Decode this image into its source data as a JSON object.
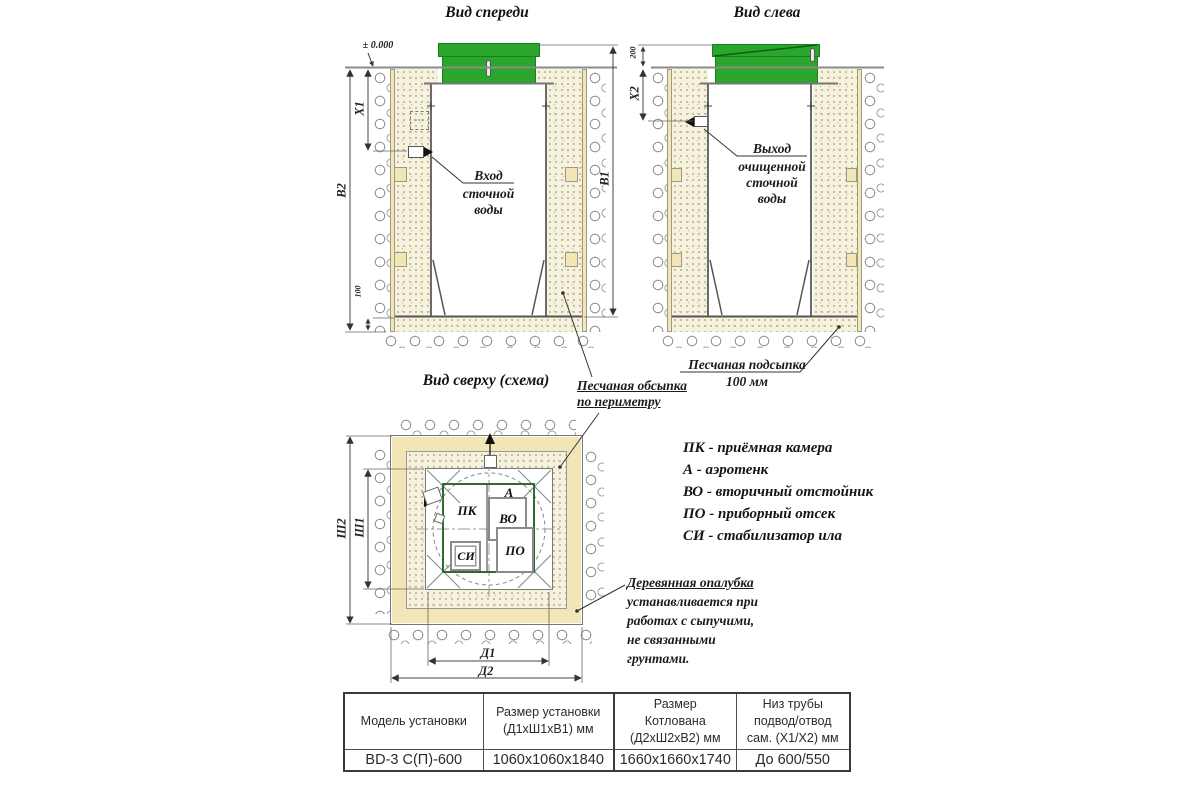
{
  "titles": {
    "front_view": "Вид спереди",
    "left_view": "Вид слева",
    "top_view": "Вид сверху (схема)"
  },
  "front_view": {
    "level_mark": "± 0.000",
    "dim_x1": "X1",
    "dim_b2": "В2",
    "dim_b1": "В1",
    "dim_sand_bed": "100",
    "inlet_title": "Вход",
    "inlet_rest": "сточной\nводы"
  },
  "left_view": {
    "dim_x2": "X2",
    "dim_lid": "200",
    "outlet_title": "Выход",
    "outlet_rest": "очищенной\nсточной\nводы",
    "sand_note_title": "Песчаная подсыпка",
    "sand_note_value": "100 мм"
  },
  "top_view": {
    "dim_sh1": "Ш1",
    "dim_sh2": "Ш2",
    "dim_d1": "Д1",
    "dim_d2": "Д2",
    "compartments": {
      "pk": "ПК",
      "a": "А",
      "vo": "ВО",
      "po": "ПО",
      "si": "СИ"
    }
  },
  "notes": {
    "backfill": "Песчаная обсыпка\nпо периметру",
    "formwork_title": "Деревянная опалубка",
    "formwork_rest": "устанавливается при\nработах с сыпучими,\nне связанными\nгрунтами."
  },
  "legend": {
    "items": [
      "ПК - приёмная камера",
      "А - аэротенк",
      "ВО - вторичный отстойник",
      "ПО - приборный отсек",
      "СИ - стабилизатор ила"
    ]
  },
  "table": {
    "headers": [
      "Модель установки",
      "Размер установки\n(Д1хШ1хВ1) мм",
      "Размер\nКотлована\n(Д2хШ2хВ2) мм",
      "Низ трубы\nподвод/отвод\nсам. (Х1/Х2) мм"
    ],
    "rows": [
      [
        "BD-3 С(П)-600",
        "1060х1060х1840",
        "1660х1660х1740",
        "До 600/550"
      ]
    ]
  },
  "colors": {
    "lid_green": "#2aa62c",
    "tank_outline_green": "#2e6b2e",
    "wood": "#f3e6b6",
    "sand": "#f6f2de"
  }
}
